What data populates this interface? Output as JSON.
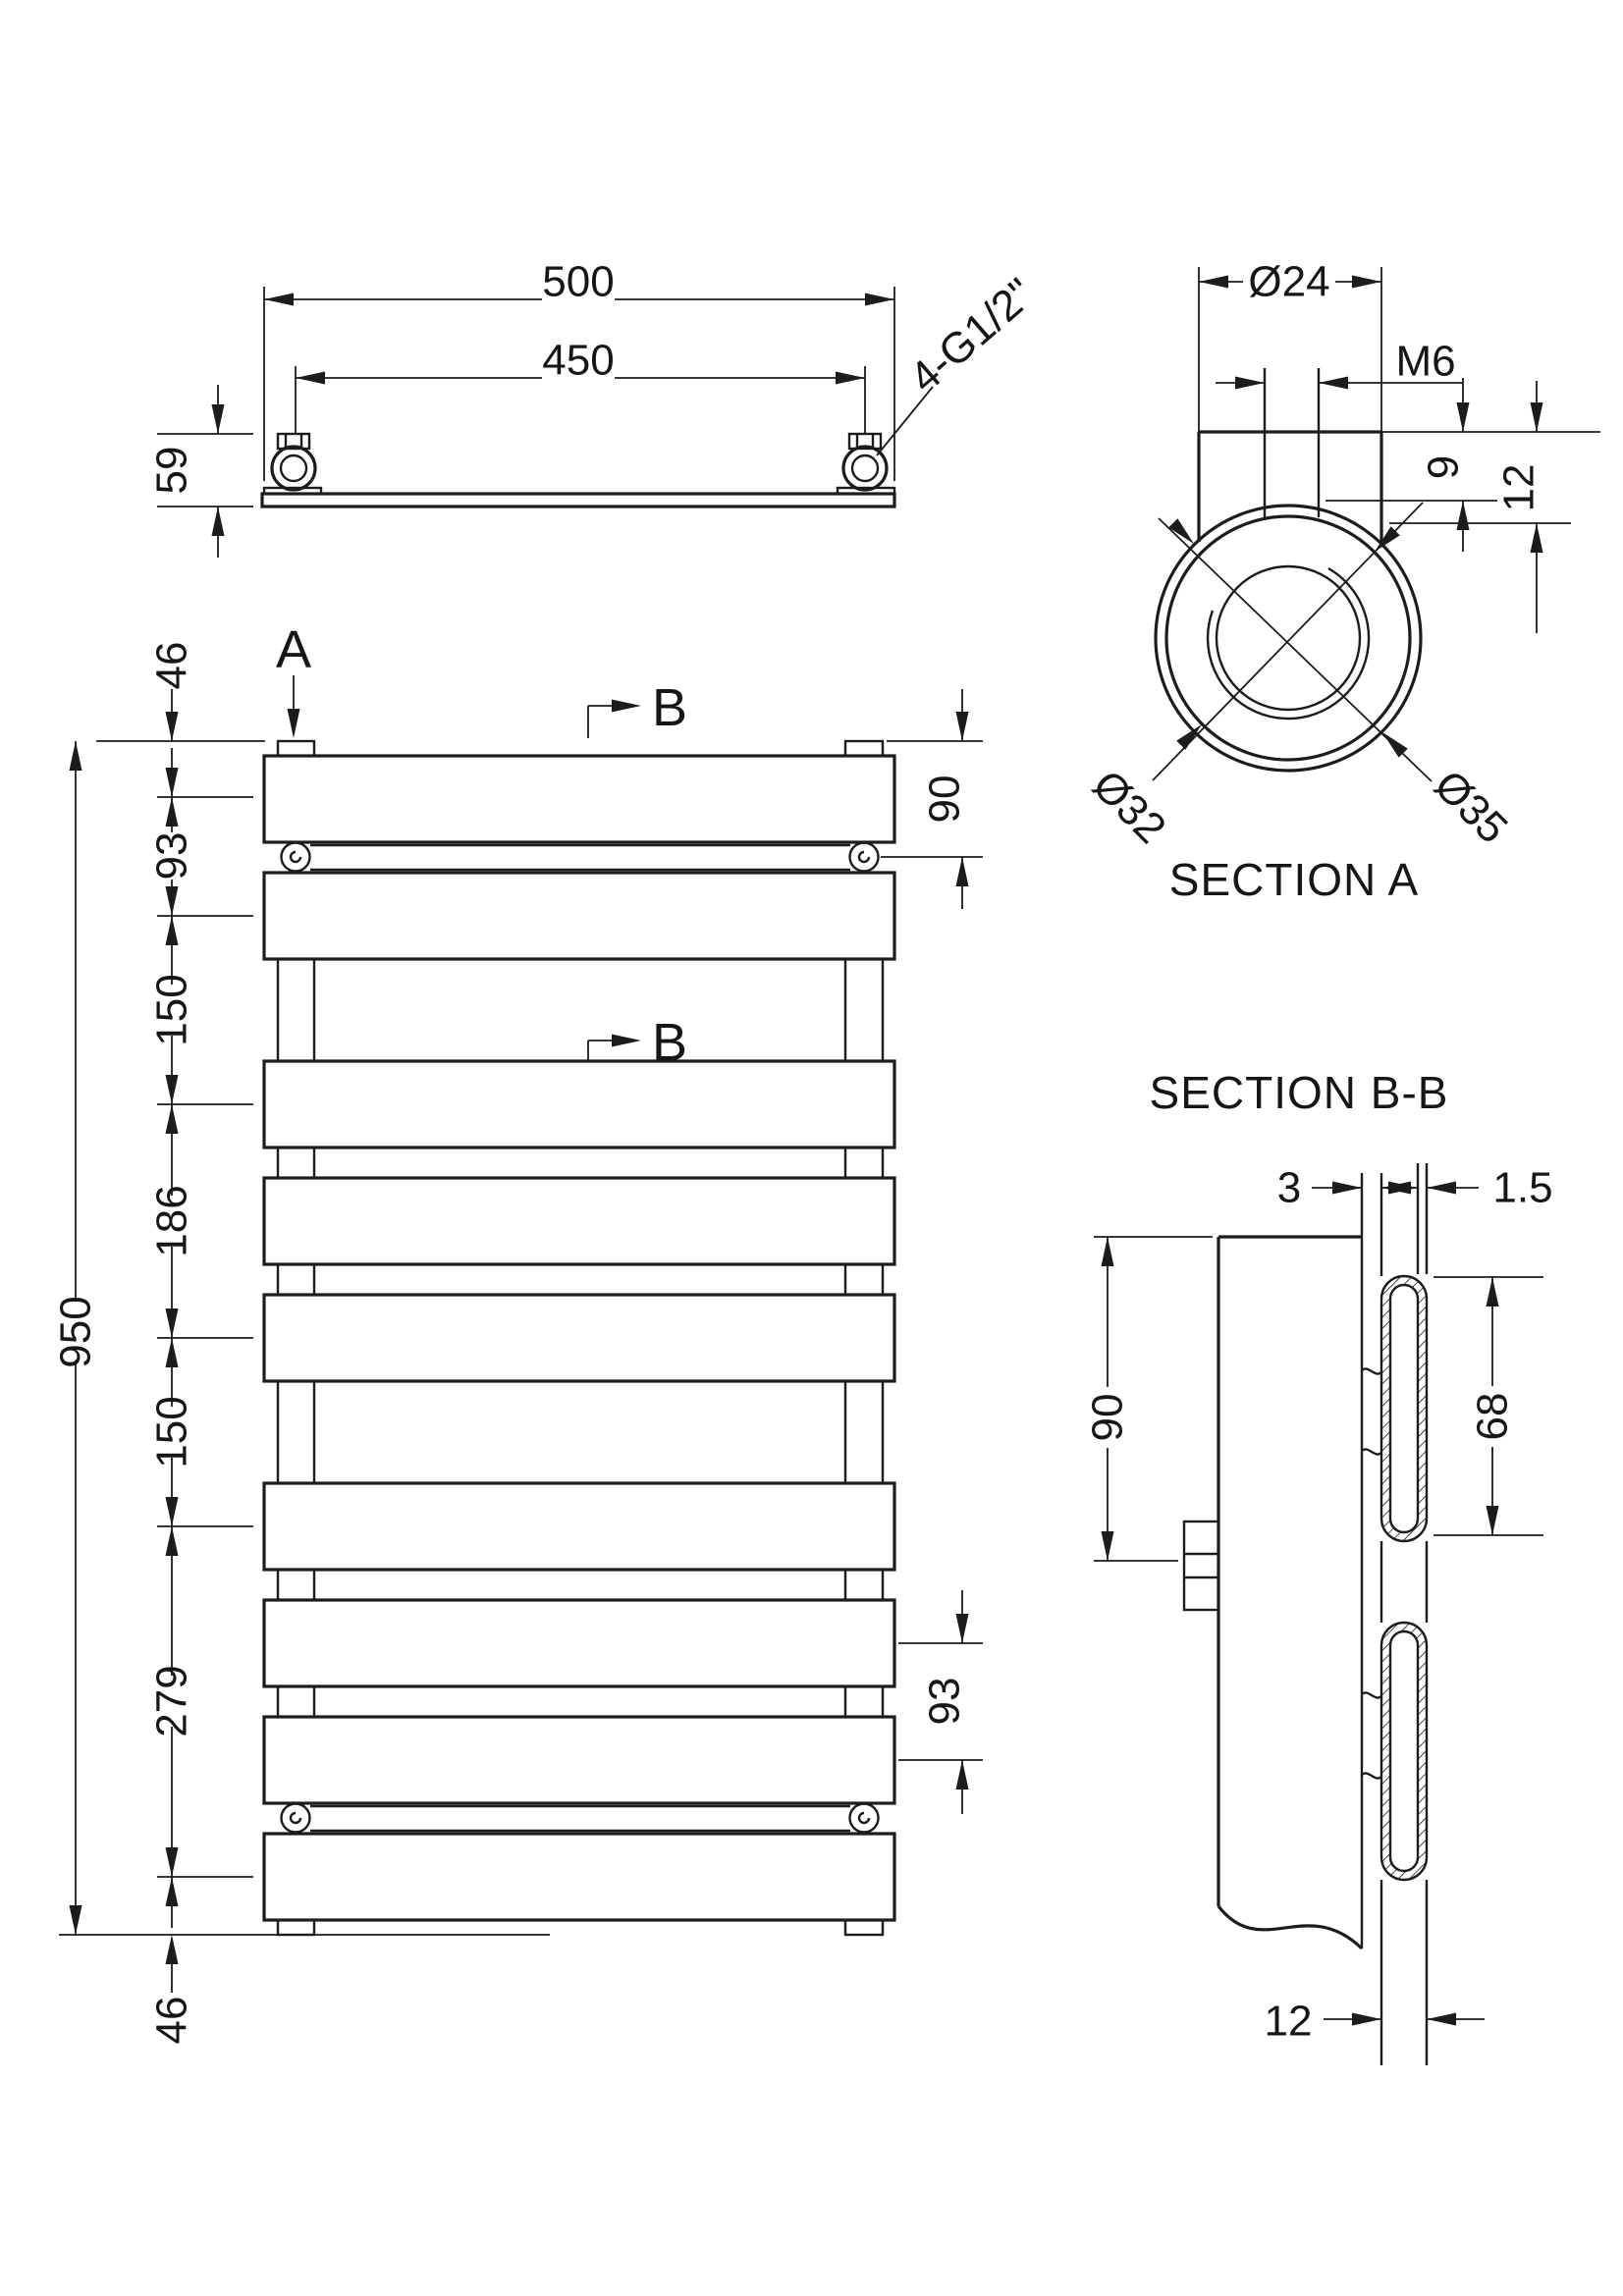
{
  "drawing": {
    "top_view": {
      "dim_width": "500",
      "dim_centers": "450",
      "dim_height": "59",
      "fitting_label": "4-G1/2\""
    },
    "section_a": {
      "title": "SECTION A",
      "dim_outer": "Ø24",
      "dim_thread": "M6",
      "dim_depth1": "9",
      "dim_depth2": "12",
      "dim_d32": "Ø32",
      "dim_d35": "Ø35"
    },
    "front_view": {
      "marker_a": "A",
      "marker_b": "B",
      "overall_height": "950",
      "chain": [
        "46",
        "93",
        "150",
        "186",
        "150",
        "279",
        "46"
      ],
      "right_top": "90",
      "right_bottom": "93"
    },
    "section_bb": {
      "title": "SECTION B-B",
      "dim_wall": "3",
      "dim_tube_wall": "1.5",
      "dim_panel": "90",
      "dim_slot": "68",
      "dim_tube": "12"
    }
  }
}
